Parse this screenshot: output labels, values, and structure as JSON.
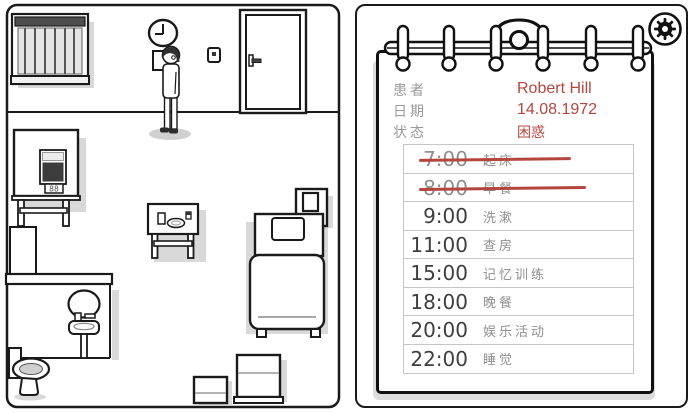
{
  "scene": {
    "tv_display": "88",
    "clock_time": "9:00"
  },
  "clipboard": {
    "fields": [
      {
        "label": "患者",
        "value": "Robert Hill"
      },
      {
        "label": "日期",
        "value": "14.08.1972"
      },
      {
        "label": "状态",
        "value": "困惑"
      }
    ],
    "schedule": {
      "rows": [
        {
          "time": "7:00",
          "activity": "起床",
          "crossed": true
        },
        {
          "time": "8:00",
          "activity": "早餐",
          "crossed": true
        },
        {
          "time": "9:00",
          "activity": "洗漱",
          "crossed": false
        },
        {
          "time": "11:00",
          "activity": "查房",
          "crossed": false
        },
        {
          "time": "15:00",
          "activity": "记忆训练",
          "crossed": false
        },
        {
          "time": "18:00",
          "activity": "晚餐",
          "crossed": false
        },
        {
          "time": "20:00",
          "activity": "娱乐活动",
          "crossed": false
        },
        {
          "time": "22:00",
          "activity": "睡觉",
          "crossed": false
        }
      ]
    }
  },
  "icons": {
    "settings": "gear-icon"
  },
  "colors": {
    "accent_red": "#b5463e",
    "label_gray": "#9a9a9a",
    "activity_gray": "#8f8f8f",
    "time_dark": "#3e3e3e",
    "shadow_gray": "#dcdcdc"
  }
}
